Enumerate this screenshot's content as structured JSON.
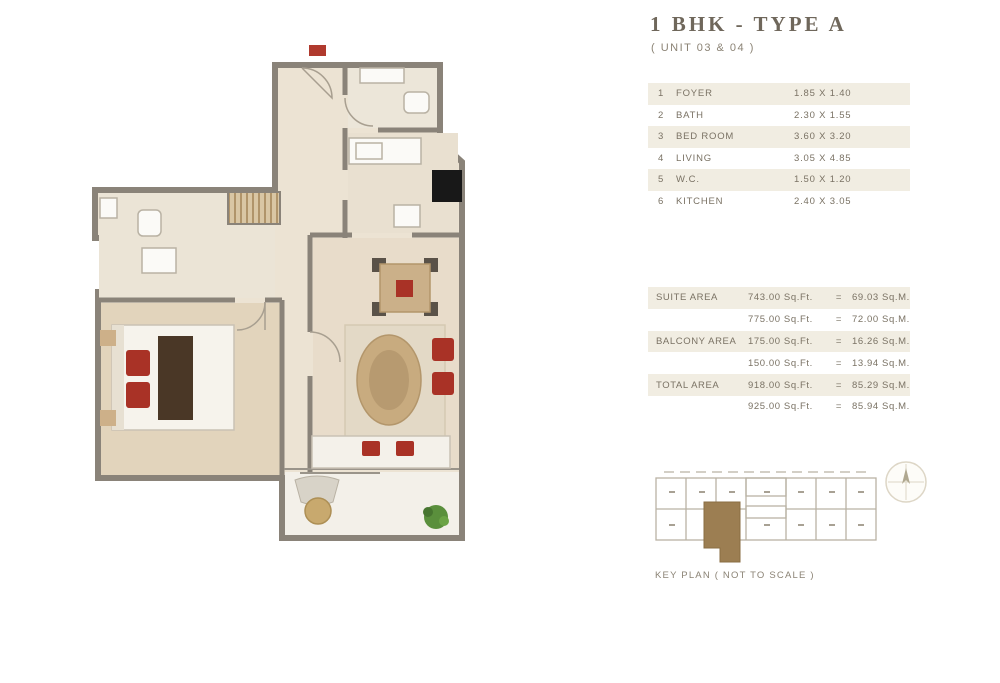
{
  "header": {
    "title": "1 BHK  -  TYPE A",
    "subtitle": "( UNIT 03 & 04 )"
  },
  "rooms_table": {
    "rows": [
      {
        "no": "1",
        "name": "FOYER",
        "dim": "1.85 X 1.40"
      },
      {
        "no": "2",
        "name": "BATH",
        "dim": "2.30 X 1.55"
      },
      {
        "no": "3",
        "name": "BED ROOM",
        "dim": "3.60 X 3.20"
      },
      {
        "no": "4",
        "name": "LIVING",
        "dim": "3.05 X 4.85"
      },
      {
        "no": "5",
        "name": "W.C.",
        "dim": "1.50 X 1.20"
      },
      {
        "no": "6",
        "name": "KITCHEN",
        "dim": "2.40 X 3.05"
      }
    ]
  },
  "areas_table": {
    "rows": [
      {
        "label": "SUITE AREA",
        "sqft": "743.00 Sq.Ft.",
        "eq": "=",
        "sqm": "69.03 Sq.M."
      },
      {
        "label": "",
        "sqft": "775.00 Sq.Ft.",
        "eq": "=",
        "sqm": "72.00 Sq.M."
      },
      {
        "label": "BALCONY AREA",
        "sqft": "175.00 Sq.Ft.",
        "eq": "=",
        "sqm": "16.26 Sq.M."
      },
      {
        "label": "",
        "sqft": "150.00 Sq.Ft.",
        "eq": "=",
        "sqm": "13.94 Sq.M."
      },
      {
        "label": "TOTAL AREA",
        "sqft": "918.00 Sq.Ft.",
        "eq": "=",
        "sqm": "85.29 Sq.M."
      },
      {
        "label": "",
        "sqft": "925.00 Sq.Ft.",
        "eq": "=",
        "sqm": "85.94 Sq.M."
      }
    ]
  },
  "key_plan": {
    "caption": "KEY PLAN ( NOT TO SCALE )"
  },
  "colors": {
    "accent_red": "#b03a2e",
    "wall_gray": "#8a8379",
    "unit_highlight": "#9c7e52",
    "table_shade": "#f1ede2",
    "text": "#7a7264",
    "plant_green": "#5a8f3c"
  }
}
